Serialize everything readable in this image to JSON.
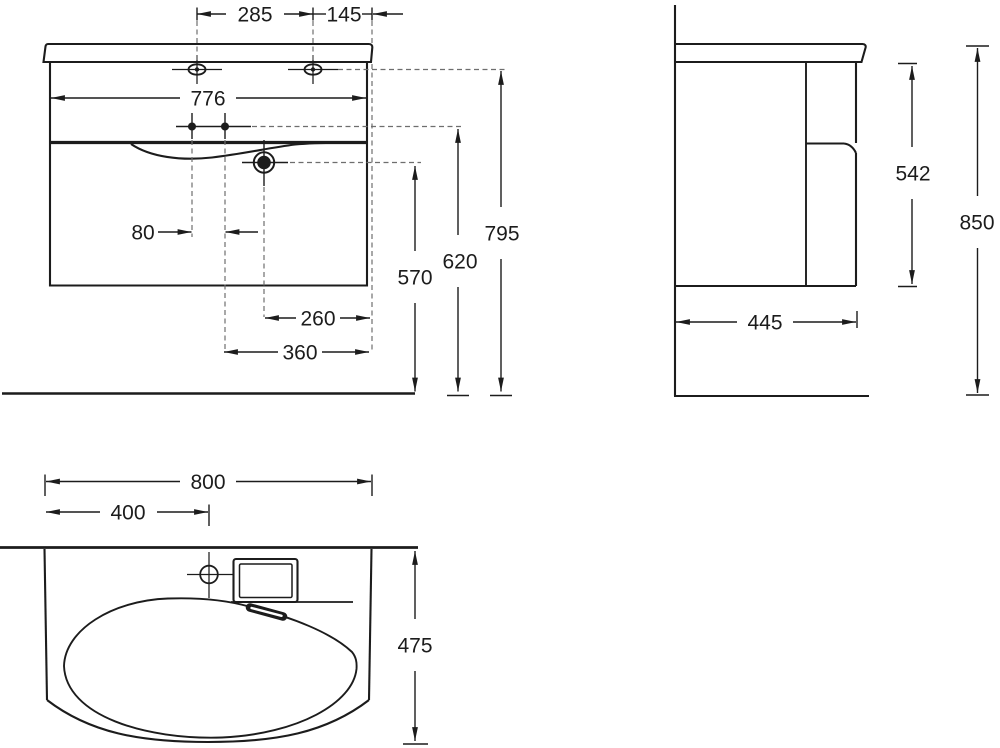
{
  "colors": {
    "ink": "#1c1c1c",
    "construction_line": "#6e6e6e",
    "background": "#ffffff"
  },
  "dimensions": {
    "front": {
      "faucet_hole_spacing": "285",
      "hole_to_edge": "145",
      "cabinet_width": "776",
      "mount_hole_spacing": "80",
      "drain_height": "570",
      "mount_height": "620",
      "top_height": "795",
      "drain_offset": "260",
      "mount_offset": "360"
    },
    "side": {
      "under_top_height": "542",
      "total_height": "850",
      "depth": "445"
    },
    "plan": {
      "basin_width": "800",
      "faucet_offset": "400",
      "basin_depth": "475"
    }
  }
}
